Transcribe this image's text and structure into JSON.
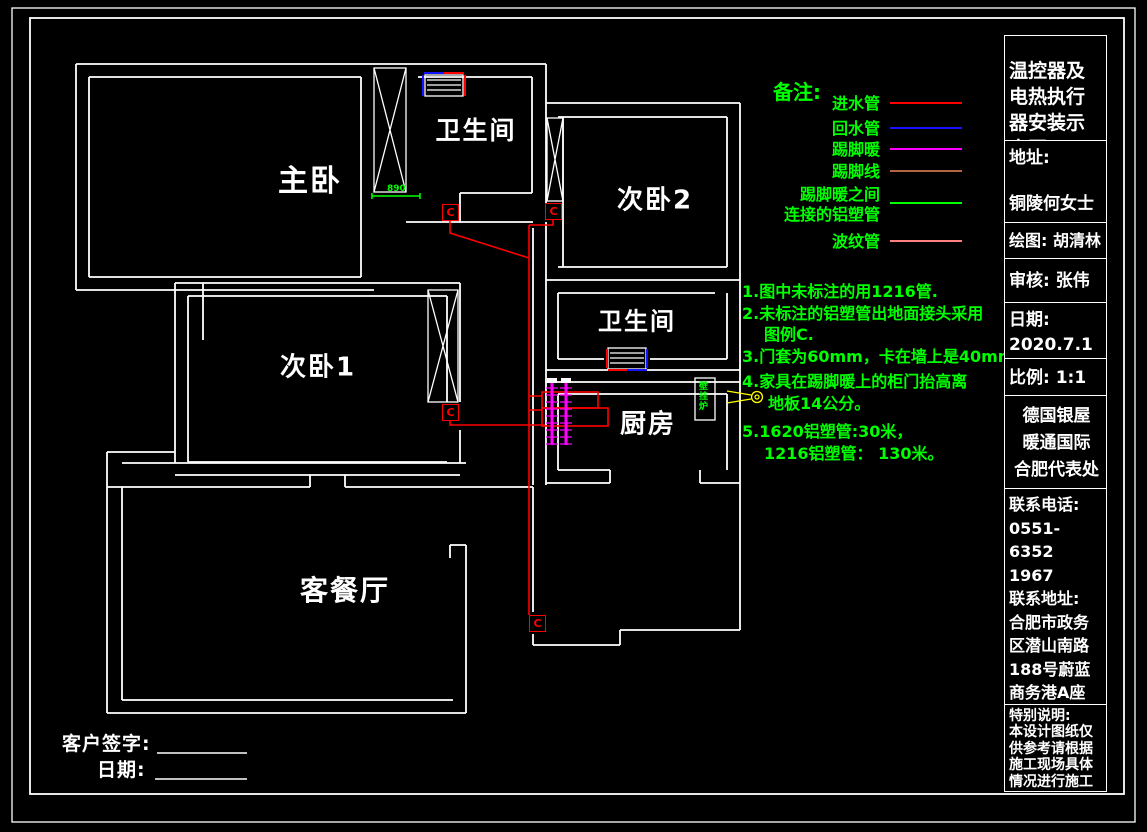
{
  "file_path": "W:\\门市\\产品图中...何女士.prg",
  "title_block": {
    "sections": [
      {
        "text": "温控器及\n电热执行\n器安装示\n意图",
        "h": 105,
        "size": 19,
        "lh": 26,
        "pt": 22,
        "align": "left"
      },
      {
        "text": "地址:\n\n铜陵何女士",
        "h": 82,
        "size": 17,
        "lh": 23,
        "pt": 6,
        "align": "left"
      },
      {
        "text": "绘图: 胡清林",
        "h": 36,
        "size": 16,
        "lh": 22,
        "pt": 7,
        "align": "left"
      },
      {
        "text": "审核: 张伟",
        "h": 44,
        "size": 17,
        "lh": 22,
        "pt": 11,
        "align": "left"
      },
      {
        "text": "日期:\n2020.7.1",
        "h": 56,
        "size": 17,
        "lh": 25,
        "pt": 5,
        "align": "left"
      },
      {
        "text": "比例: 1:1",
        "h": 37,
        "size": 17,
        "lh": 22,
        "pt": 8,
        "align": "left"
      },
      {
        "text": "德国银屋\n暖通国际\n合肥代表处",
        "h": 93,
        "size": 17,
        "lh": 27,
        "pt": 7,
        "align": "center"
      },
      {
        "text": "联系电话:\n0551-6352\n1967\n联系地址:\n合肥市政务\n区潜山南路\n188号蔚蓝\n商务港A座\n402",
        "h": 216,
        "size": 16,
        "lh": 23.5,
        "pt": 4,
        "align": "left"
      },
      {
        "text": "特别说明:\n本设计图纸仅\n供参考请根据\n施工现场具体\n情况进行施工",
        "h": 86,
        "size": 14,
        "lh": 16.4,
        "pt": 3,
        "align": "left"
      }
    ]
  },
  "legend": {
    "title": "备注:",
    "items": [
      {
        "label": "进水管",
        "color": "#ff0000",
        "y": 94,
        "two_line": false
      },
      {
        "label": "回水管",
        "color": "#1414ff",
        "y": 119,
        "two_line": false
      },
      {
        "label": "踢脚暖",
        "color": "#ff00ff",
        "y": 140,
        "two_line": false
      },
      {
        "label": "踢脚线",
        "color": "#b4643c",
        "y": 162,
        "two_line": false
      },
      {
        "label": "踢脚暖之间\n连接的铝塑管",
        "color": "#00ff00",
        "y": 185,
        "two_line": true
      },
      {
        "label": "波纹管",
        "color": "#ff8080",
        "y": 232,
        "two_line": false
      }
    ]
  },
  "notes": {
    "lines": [
      {
        "text": "1.图中未标注的用1216管.",
        "x": 742,
        "y": 278
      },
      {
        "text": "2.未标注的铝塑管出地面接头采用",
        "x": 742,
        "y": 300
      },
      {
        "text": "图例C.",
        "x": 764,
        "y": 321
      },
      {
        "text": "3.门套为60mm，卡在墙上是40mm.",
        "x": 742,
        "y": 343
      },
      {
        "text": "4.家具在踢脚暖上的柜门抬高离",
        "x": 742,
        "y": 368
      },
      {
        "text": "地板14公分。",
        "x": 768,
        "y": 390
      },
      {
        "text": "5.1620铝塑管:30米，",
        "x": 742,
        "y": 418
      },
      {
        "text": "1216铝塑管： 130米。",
        "x": 764,
        "y": 440
      }
    ]
  },
  "floorplan": {
    "rooms": [
      {
        "name": "主卧",
        "x": 310,
        "y": 178,
        "size": 30
      },
      {
        "name": "卫生间",
        "x": 476,
        "y": 129,
        "size": 25
      },
      {
        "name": "次卧2",
        "x": 655,
        "y": 198,
        "size": 26
      },
      {
        "name": "次卧1",
        "x": 318,
        "y": 365,
        "size": 26
      },
      {
        "name": "卫生间",
        "x": 637,
        "y": 319,
        "size": 24
      },
      {
        "name": "厨房",
        "x": 648,
        "y": 422,
        "size": 26
      },
      {
        "name": "客餐厅",
        "x": 345,
        "y": 589,
        "size": 28
      }
    ],
    "markers": [
      {
        "label": "C",
        "x": 450,
        "y": 212
      },
      {
        "label": "C",
        "x": 553,
        "y": 211
      },
      {
        "label": "C",
        "x": 450,
        "y": 412
      },
      {
        "label": "C",
        "x": 537,
        "y": 623
      }
    ],
    "dimension": {
      "text": "890",
      "x": 387,
      "y": 184
    },
    "boiler": {
      "text": "壁挂炉",
      "x": 699,
      "y": 382
    }
  },
  "signature": {
    "sign": "客户签字:",
    "date": "日期:"
  },
  "colors": {
    "wall": "#ffffff",
    "inlet": "#ff0000",
    "return": "#1414ff",
    "baseboard_heat": "#ff00ff",
    "baseboard_line": "#b4643c",
    "alu_pipe": "#00ff00",
    "corrugated": "#ff8080",
    "callout": "#ffff00"
  }
}
